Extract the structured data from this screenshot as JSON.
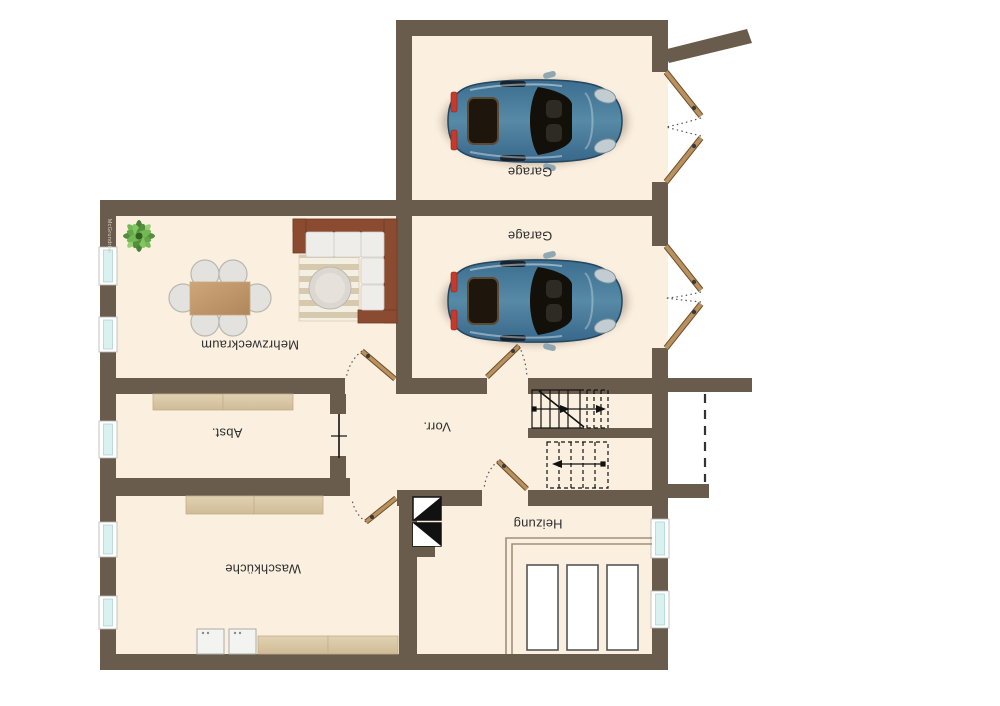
{
  "watermark": "McGrundriss",
  "rooms": [
    {
      "key": "garage-1",
      "name": "Garage"
    },
    {
      "key": "garage-2",
      "name": "Garage"
    },
    {
      "key": "mehrzweckraum",
      "name": "Mehrzweckraum"
    },
    {
      "key": "abstellraum",
      "name": "Abst."
    },
    {
      "key": "vorraum",
      "name": "Vorr."
    },
    {
      "key": "waschkueche",
      "name": "Waschküche"
    },
    {
      "key": "heizung",
      "name": "Heizung"
    }
  ],
  "furniture": {
    "garage_1": [
      "car"
    ],
    "garage_2": [
      "car"
    ],
    "mehrzweckraum": [
      "dining-table",
      "six-chairs",
      "corner-sofa",
      "striped-rug",
      "round-coffee-table",
      "potted-plant"
    ],
    "abstellraum": [
      "shelf"
    ],
    "waschkueche": [
      "counters",
      "washer",
      "dryer"
    ],
    "heizung": [
      "three-heating-tanks",
      "platform",
      "chimney-flues"
    ]
  },
  "symbols": {
    "double_swing_garage_doors": 2,
    "single_doors_with_swing_arc": 4,
    "closed_door_line": 1,
    "staircase": "u-shaped, lower flight solid, upper flight dashed, walk line with arrows",
    "chimney": "two flue squares (black/white diagonal halves)",
    "dashed_line_right": "overhead edge at exterior landing"
  },
  "colors": {
    "background": "#ffffff",
    "wall": "#6a5c4d",
    "floor": "#fbf0e0",
    "door_leaf": "#b9905f",
    "window_glass": "#d9f2f1",
    "car_body": "#3f7294",
    "sofa_frame": "#8a4b31",
    "counter": "#dbc9a7",
    "label_text": "#2e2e2e"
  }
}
